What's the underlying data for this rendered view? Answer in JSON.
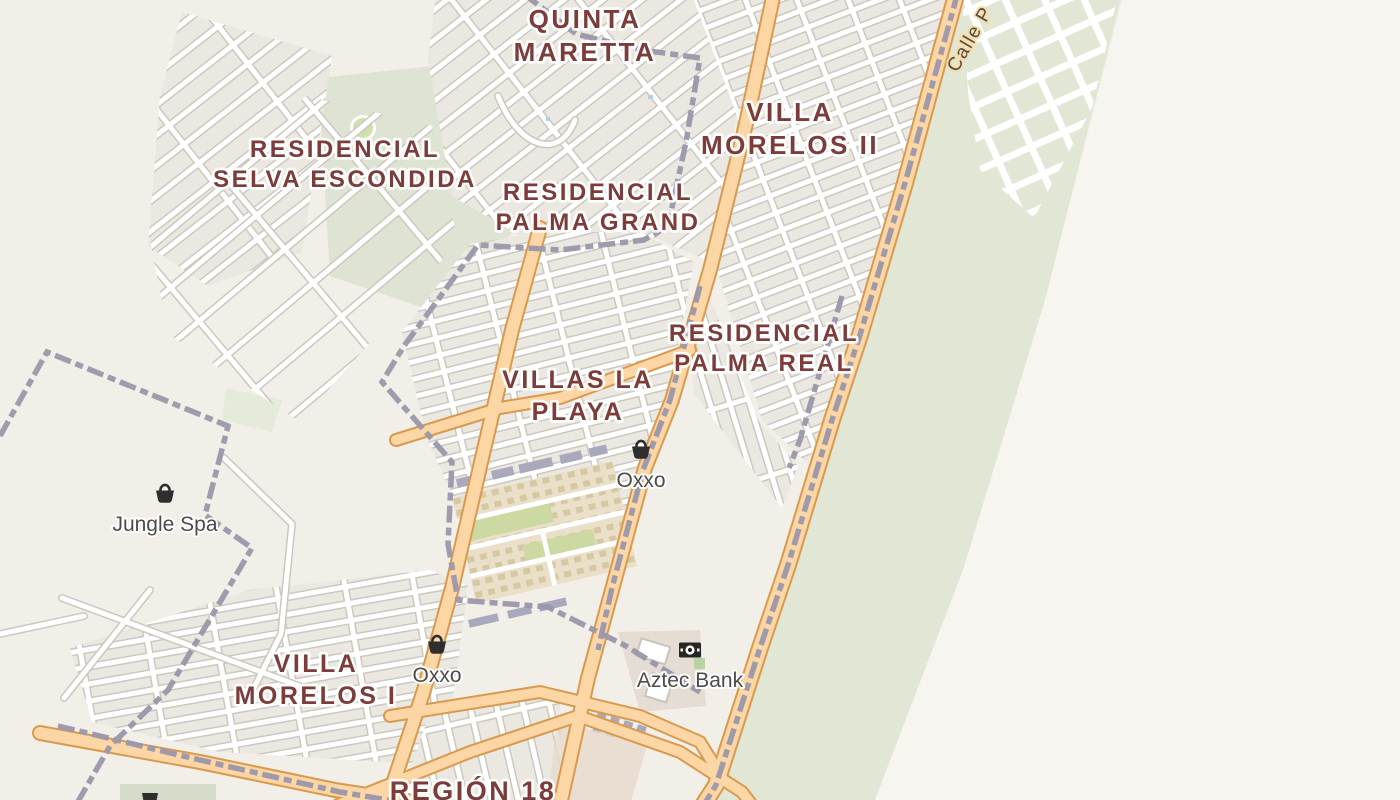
{
  "map": {
    "neighborhoods": [
      {
        "lines": [
          "QUINTA",
          "MARETTA"
        ],
        "x": 585,
        "y": 28,
        "size": 26
      },
      {
        "lines": [
          "VILLA",
          "MORELOS II"
        ],
        "x": 790,
        "y": 121,
        "size": 26
      },
      {
        "lines": [
          "RESIDENCIAL",
          "SELVA ESCONDIDA"
        ],
        "x": 345,
        "y": 157,
        "size": 24
      },
      {
        "lines": [
          "RESIDENCIAL",
          "PALMA GRAND"
        ],
        "x": 598,
        "y": 200,
        "size": 24
      },
      {
        "lines": [
          "RESIDENCIAL",
          "PALMA REAL"
        ],
        "x": 764,
        "y": 341,
        "size": 24
      },
      {
        "lines": [
          "VILLAS LA",
          "PLAYA"
        ],
        "x": 578,
        "y": 388,
        "size": 25
      },
      {
        "lines": [
          "VILLA",
          "MORELOS I"
        ],
        "x": 316,
        "y": 672,
        "size": 25
      },
      {
        "lines": [
          "REGIÓN 18"
        ],
        "x": 473,
        "y": 800,
        "size": 27
      }
    ],
    "pois": [
      {
        "name": "Oxxo",
        "icon": "basket",
        "x": 641,
        "y": 450,
        "label_y": 487
      },
      {
        "name": "Jungle Spa",
        "icon": "basket",
        "x": 165,
        "y": 494,
        "label_y": 531
      },
      {
        "name": "Oxxo",
        "icon": "basket",
        "x": 437,
        "y": 645,
        "label_y": 682
      },
      {
        "name": "Aztec Bank",
        "icon": "banknote",
        "x": 690,
        "y": 650,
        "label_y": 687
      }
    ],
    "street_labels": [
      {
        "name": "Calle P",
        "x": 975,
        "y": 42,
        "rotation": -60
      }
    ],
    "colors": {
      "background": "#f2efe9",
      "background_light": "#f7f5ef",
      "block": "#ebe8e2",
      "greenery": "#e2e6d5",
      "park": "#dfe3d3",
      "allotment": "#eadfc8",
      "allotment_dot": "#d7c8a4",
      "allotment_green": "#ccd9a2",
      "road_primary_fill": "#fcd6a4",
      "road_primary_casing": "#d89a4f",
      "street_casing": "#ccc8bf",
      "boundary_dash": "#9b97aa",
      "building": "#a9a8bc",
      "water": "#b5d0e8",
      "district_label": "#7d3c3c",
      "poi_label": "#4c4c4c",
      "street_label": "#4d4d4d"
    }
  }
}
